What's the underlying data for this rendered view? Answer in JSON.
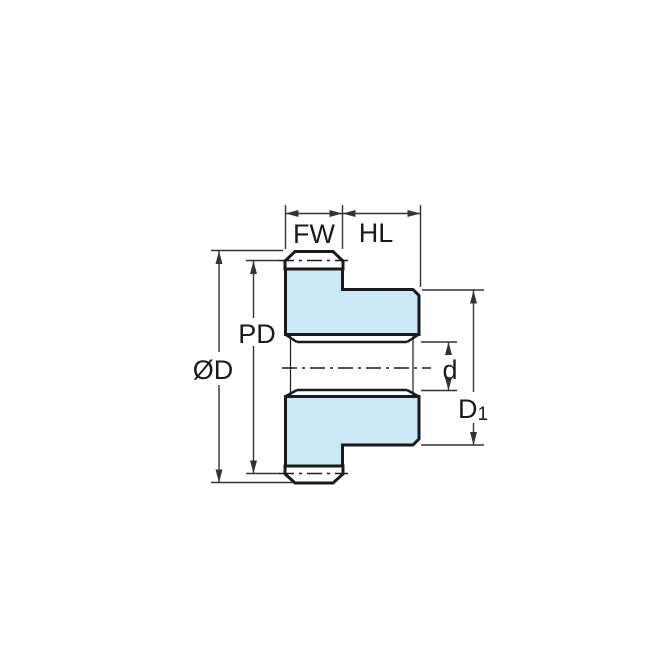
{
  "title": "Spur gear cross-section dimension diagram",
  "colors": {
    "fill": "#cce8f7",
    "line": "#1a1a1a",
    "dim": "#333333",
    "background": "#ffffff"
  },
  "dimensions": {
    "face_width": {
      "label": "FW"
    },
    "hub_length": {
      "label": "HL"
    },
    "pitch_diameter": {
      "label": "PD"
    },
    "outside_diameter": {
      "label": "ØD"
    },
    "bore_diameter": {
      "label": "d"
    },
    "hub_diameter": {
      "main": "D",
      "sub": "1"
    }
  }
}
